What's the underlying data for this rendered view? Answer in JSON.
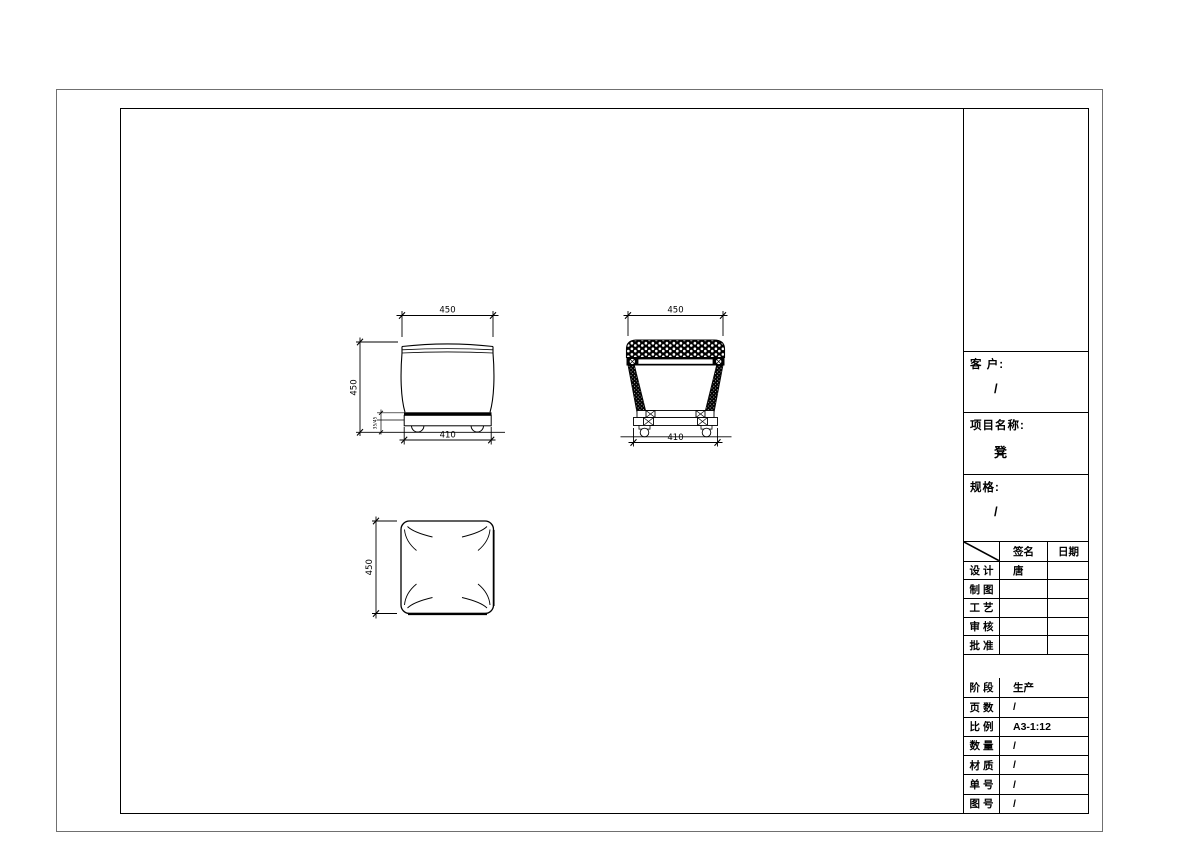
{
  "title_block": {
    "customer": {
      "label": "客 户:",
      "value": "/"
    },
    "project": {
      "label": "项目名称:",
      "value": "凳"
    },
    "spec": {
      "label": "规格:",
      "value": "/"
    },
    "sign_table": {
      "header_signature": "签名",
      "header_date": "日期",
      "rows": [
        {
          "label": "设 计",
          "signature": "唐",
          "date": ""
        },
        {
          "label": "制 图",
          "signature": "",
          "date": ""
        },
        {
          "label": "工 艺",
          "signature": "",
          "date": ""
        },
        {
          "label": "审 核",
          "signature": "",
          "date": ""
        },
        {
          "label": "批 准",
          "signature": "",
          "date": ""
        }
      ]
    },
    "info_table": {
      "rows": [
        {
          "label": "阶 段",
          "value": "生产"
        },
        {
          "label": "页 数",
          "value": "/"
        },
        {
          "label": "比 例",
          "value": "A3-1:12"
        },
        {
          "label": "数 量",
          "value": "/"
        },
        {
          "label": "材 质",
          "value": "/"
        },
        {
          "label": "单 号",
          "value": "/"
        },
        {
          "label": "图 号",
          "value": "/"
        }
      ]
    }
  },
  "drawing": {
    "front_view": {
      "top_width": "450",
      "height": "450",
      "base_width": "410",
      "base_height": "35/45"
    },
    "side_view": {
      "top_width": "450",
      "base_width": "410"
    },
    "top_view": {
      "depth": "450"
    }
  }
}
